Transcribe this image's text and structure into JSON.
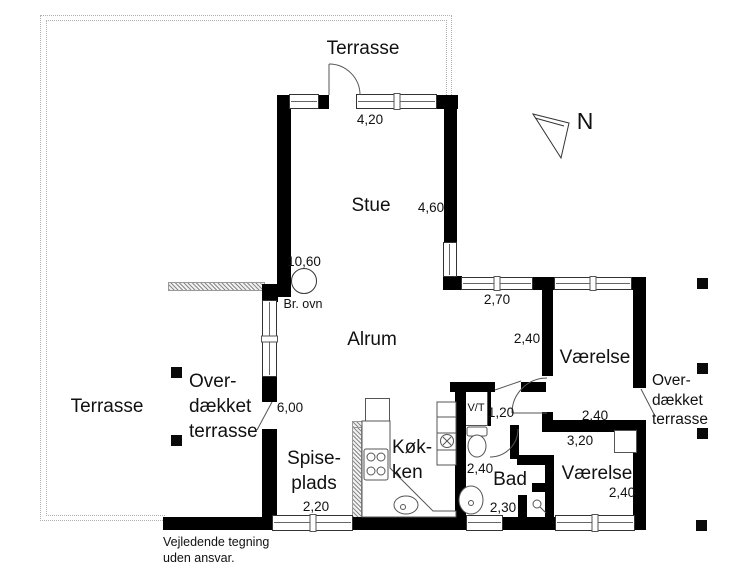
{
  "plan": {
    "north_label": "N",
    "labels": {
      "terrasse_top": "Terrasse",
      "terrasse_left": "Terrasse",
      "covered_left": [
        "Over-",
        "dækket",
        "terrasse"
      ],
      "covered_right": [
        "Over-",
        "dækket",
        "terrasse"
      ],
      "stue": "Stue",
      "alrum": "Alrum",
      "vaerelse_ne": "Værelse",
      "vaerelse_se": "Værelse",
      "bad": "Bad",
      "kokken": [
        "Køk-",
        "ken"
      ],
      "spiseplads": [
        "Spise-",
        "plads"
      ],
      "vt": "V/T",
      "br_ovn": "Br. ovn"
    },
    "dimensions": {
      "stue_width": "4,20",
      "stue_depth": "4,60",
      "alrum_width": "10,60",
      "alrum_window": "2,70",
      "alrum_east": "2,40",
      "vaerelse_ne_width": "2,40",
      "hall": "3,20",
      "entry": "1,20",
      "bad_width": "2,40",
      "bad_depth": "2,30",
      "vaerelse_se_width": "2,40",
      "spiseplads_width": "2,20",
      "west_door": "6,00"
    },
    "disclaimer": [
      "Vejledende tegning",
      "uden ansvar."
    ]
  }
}
